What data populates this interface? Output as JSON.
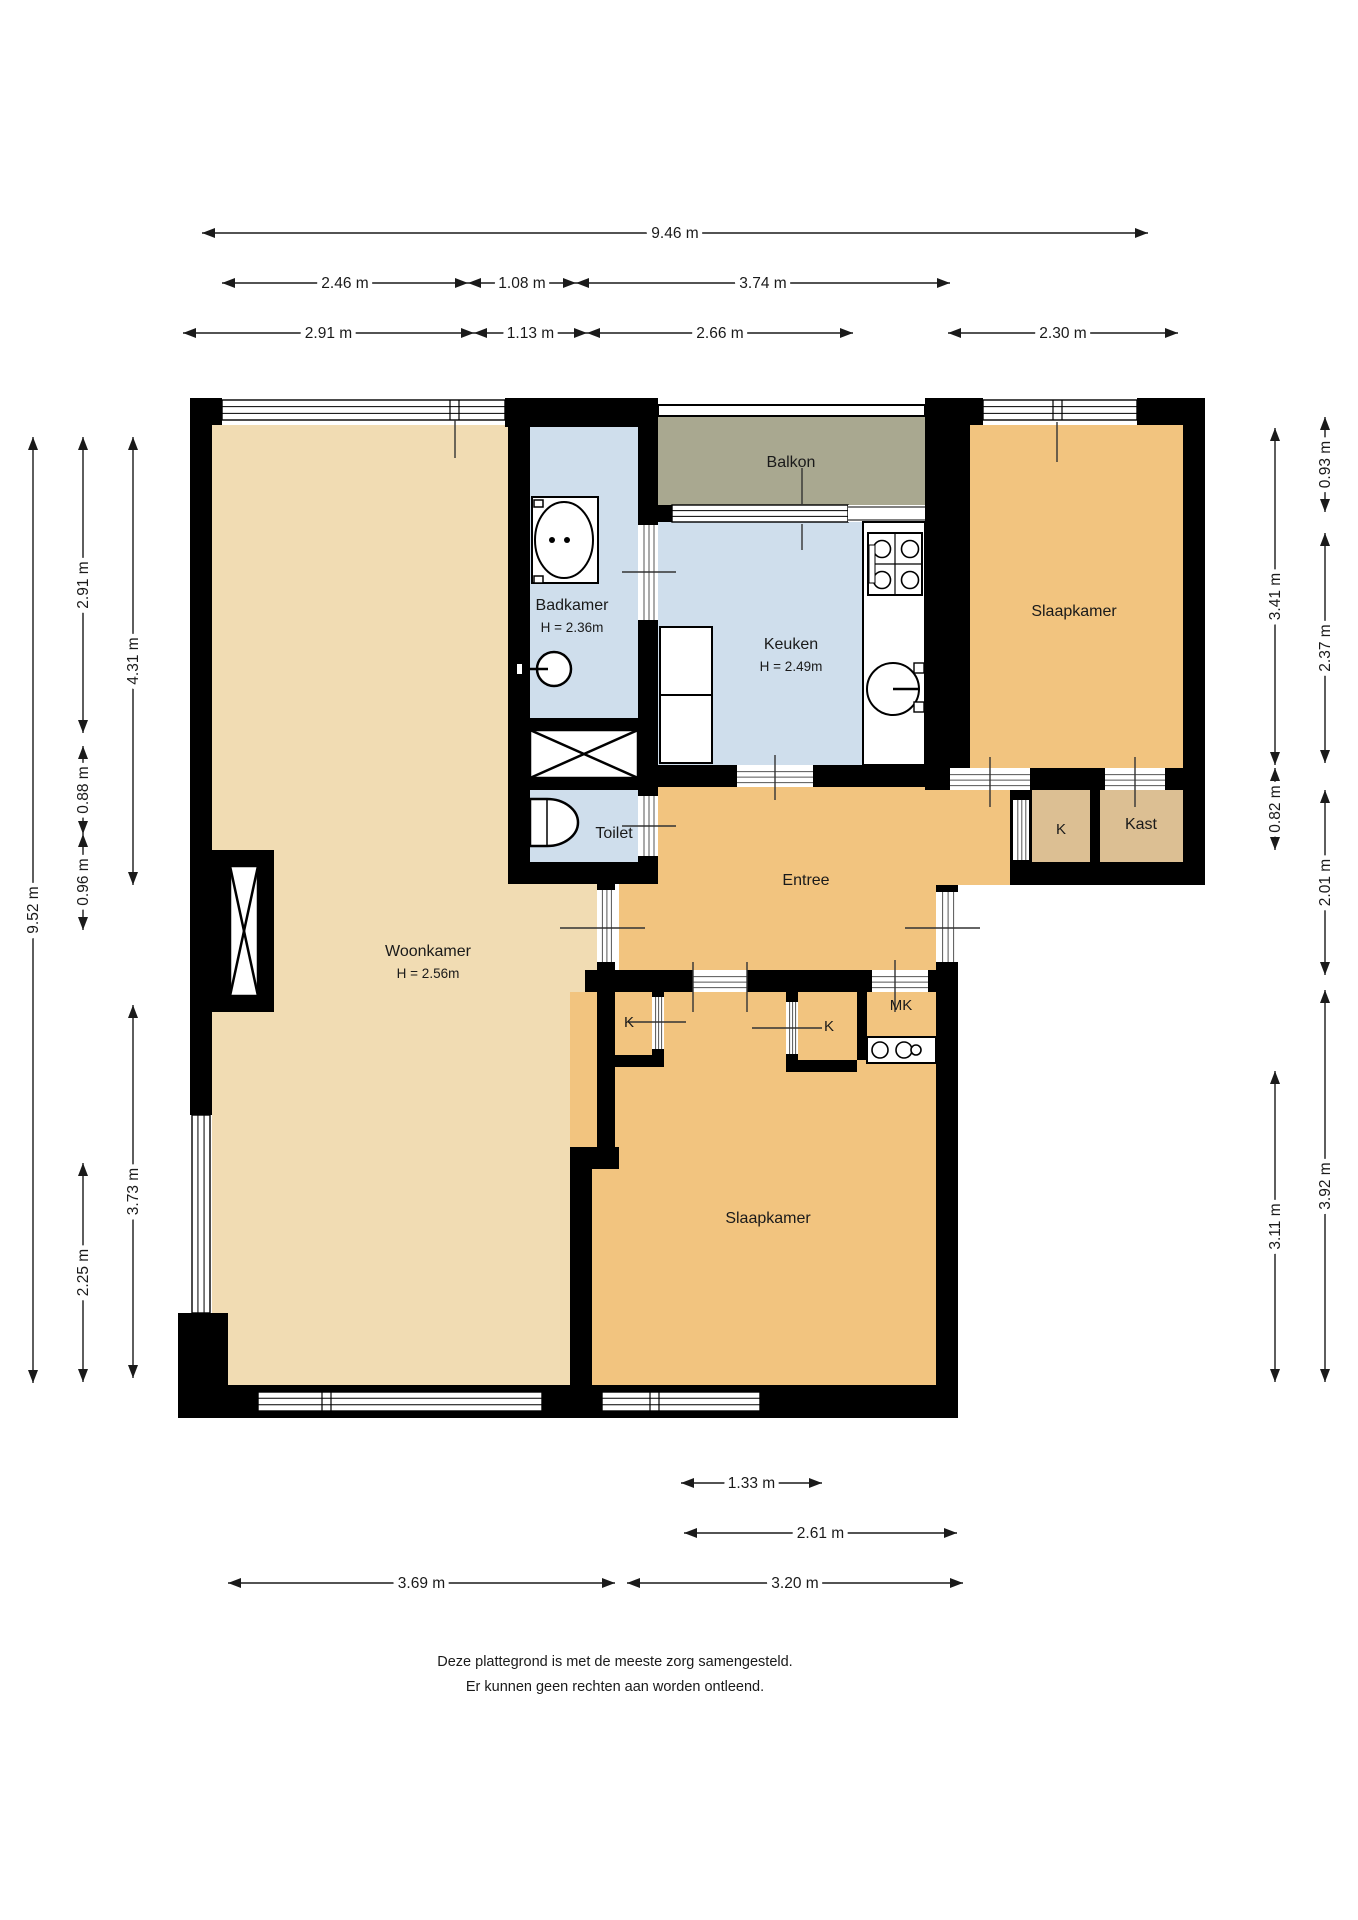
{
  "colors": {
    "wall": "#000000",
    "blue_room": "#cfdeec",
    "tan_room": "#f1dcb3",
    "orange_room": "#f2c47f",
    "closet_room": "#dcbf93",
    "balcony": "#a9a890",
    "text": "#1a1a1a",
    "background": "#ffffff"
  },
  "rooms": [
    {
      "id": "balkon",
      "label": "Balkon",
      "color_key": "balcony",
      "cx": 791,
      "cy": 467
    },
    {
      "id": "badkamer",
      "label": "Badkamer",
      "height_label": "H = 2.36m",
      "color_key": "blue_room",
      "cx": 572,
      "cy": 610,
      "sub_cy": 632
    },
    {
      "id": "keuken",
      "label": "Keuken",
      "height_label": "H = 2.49m",
      "color_key": "blue_room",
      "cx": 791,
      "cy": 649,
      "sub_cy": 671
    },
    {
      "id": "slaapkamer-1",
      "label": "Slaapkamer",
      "color_key": "orange_room",
      "cx": 1074,
      "cy": 616
    },
    {
      "id": "closet-k-1",
      "label": "K",
      "color_key": "closet_room",
      "cx": 1061,
      "cy": 834
    },
    {
      "id": "kast",
      "label": "Kast",
      "color_key": "closet_room",
      "cx": 1141,
      "cy": 829
    },
    {
      "id": "toilet",
      "label": "Toilet",
      "color_key": "blue_room",
      "cx": 614,
      "cy": 838
    },
    {
      "id": "entree",
      "label": "Entree",
      "color_key": "orange_room",
      "cx": 806,
      "cy": 885
    },
    {
      "id": "woonkamer",
      "label": "Woonkamer",
      "height_label": "H = 2.56m",
      "color_key": "tan_room",
      "cx": 428,
      "cy": 956,
      "sub_cy": 978
    },
    {
      "id": "closet-k-2",
      "label": "K",
      "color_key": "closet_room",
      "cx": 629,
      "cy": 1027
    },
    {
      "id": "closet-k-3",
      "label": "K",
      "color_key": "closet_room",
      "cx": 829,
      "cy": 1031
    },
    {
      "id": "meterkast",
      "label": "MK",
      "color_key": "closet_room",
      "cx": 901,
      "cy": 1010
    },
    {
      "id": "slaapkamer-2",
      "label": "Slaapkamer",
      "color_key": "orange_room",
      "cx": 768,
      "cy": 1223
    }
  ],
  "dimensions": {
    "top": [
      {
        "label": "9.46 m",
        "y": 233,
        "x1": 202,
        "x2": 1148
      },
      {
        "label": "2.46 m",
        "y": 283,
        "x1": 222,
        "x2": 468
      },
      {
        "label": "1.08 m",
        "y": 283,
        "x1": 468,
        "x2": 576
      },
      {
        "label": "3.74 m",
        "y": 283,
        "x1": 576,
        "x2": 950
      },
      {
        "label": "2.91 m",
        "y": 333,
        "x1": 183,
        "x2": 474
      },
      {
        "label": "1.13 m",
        "y": 333,
        "x1": 474,
        "x2": 587
      },
      {
        "label": "2.66 m",
        "y": 333,
        "x1": 587,
        "x2": 853
      },
      {
        "label": "2.30 m",
        "y": 333,
        "x1": 948,
        "x2": 1178
      }
    ],
    "bottom": [
      {
        "label": "1.33 m",
        "y": 1483,
        "x1": 681,
        "x2": 822
      },
      {
        "label": "2.61 m",
        "y": 1533,
        "x1": 684,
        "x2": 957
      },
      {
        "label": "3.69 m",
        "y": 1583,
        "x1": 228,
        "x2": 615
      },
      {
        "label": "3.20 m",
        "y": 1583,
        "x1": 627,
        "x2": 963
      }
    ],
    "left": [
      {
        "label": "9.52 m",
        "x": 33,
        "y1": 437,
        "y2": 1383
      },
      {
        "label": "2.91 m",
        "x": 83,
        "y1": 437,
        "y2": 733
      },
      {
        "label": "0.88 m",
        "x": 83,
        "y1": 746,
        "y2": 834
      },
      {
        "label": "0.96 m",
        "x": 83,
        "y1": 834,
        "y2": 930
      },
      {
        "label": "2.25 m",
        "x": 83,
        "y1": 1163,
        "y2": 1382
      },
      {
        "label": "4.31 m",
        "x": 133,
        "y1": 437,
        "y2": 885
      },
      {
        "label": "3.73 m",
        "x": 133,
        "y1": 1005,
        "y2": 1378
      }
    ],
    "right": [
      {
        "label": "0.93 m",
        "x": 1325,
        "y1": 417,
        "y2": 512
      },
      {
        "label": "2.37 m",
        "x": 1325,
        "y1": 533,
        "y2": 763
      },
      {
        "label": "2.01 m",
        "x": 1325,
        "y1": 790,
        "y2": 975
      },
      {
        "label": "3.92 m",
        "x": 1325,
        "y1": 990,
        "y2": 1382
      },
      {
        "label": "3.41 m",
        "x": 1275,
        "y1": 428,
        "y2": 765
      },
      {
        "label": "0.82 m",
        "x": 1275,
        "y1": 768,
        "y2": 850
      },
      {
        "label": "3.11 m",
        "x": 1275,
        "y1": 1071,
        "y2": 1382
      }
    ]
  },
  "footer": {
    "line1": "Deze plattegrond is met de meeste zorg samengesteld.",
    "line2": "Er kunnen geen rechten aan worden ontleend."
  }
}
